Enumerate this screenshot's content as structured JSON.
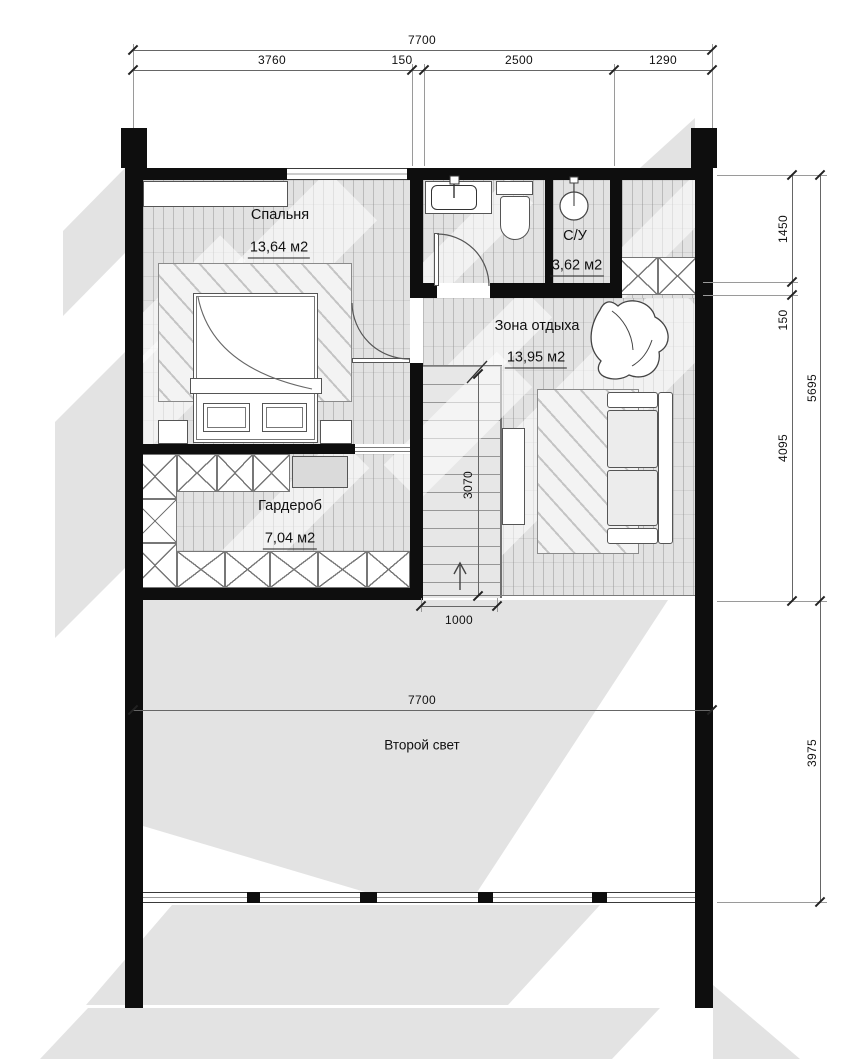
{
  "drawing": {
    "type": "floor-plan",
    "floor": "second"
  },
  "rooms": {
    "bedroom": {
      "name": "Спальня",
      "area": "13,64 м2"
    },
    "bathroom": {
      "name": "С/У",
      "area": "3,62 м2"
    },
    "lounge": {
      "name": "Зона отдыха",
      "area": "13,95 м2"
    },
    "wardrobe": {
      "name": "Гардероб",
      "area": "7,04 м2"
    },
    "void": {
      "name": "Второй свет"
    }
  },
  "dims": {
    "top_total": "7700",
    "seg_3760": "3760",
    "seg_150": "150",
    "seg_2500": "2500",
    "seg_1290": "1290",
    "right_1450": "1450",
    "right_150": "150",
    "right_5695": "5695",
    "right_4095": "4095",
    "right_3975": "3975",
    "mid_7700": "7700",
    "stair_3070": "3070",
    "stair_1000": "1000"
  },
  "colors": {
    "wall": "#0e0e0e",
    "floor": "#e2e2e2",
    "shadow": "#e3e3e3",
    "dimension": "#666666"
  }
}
